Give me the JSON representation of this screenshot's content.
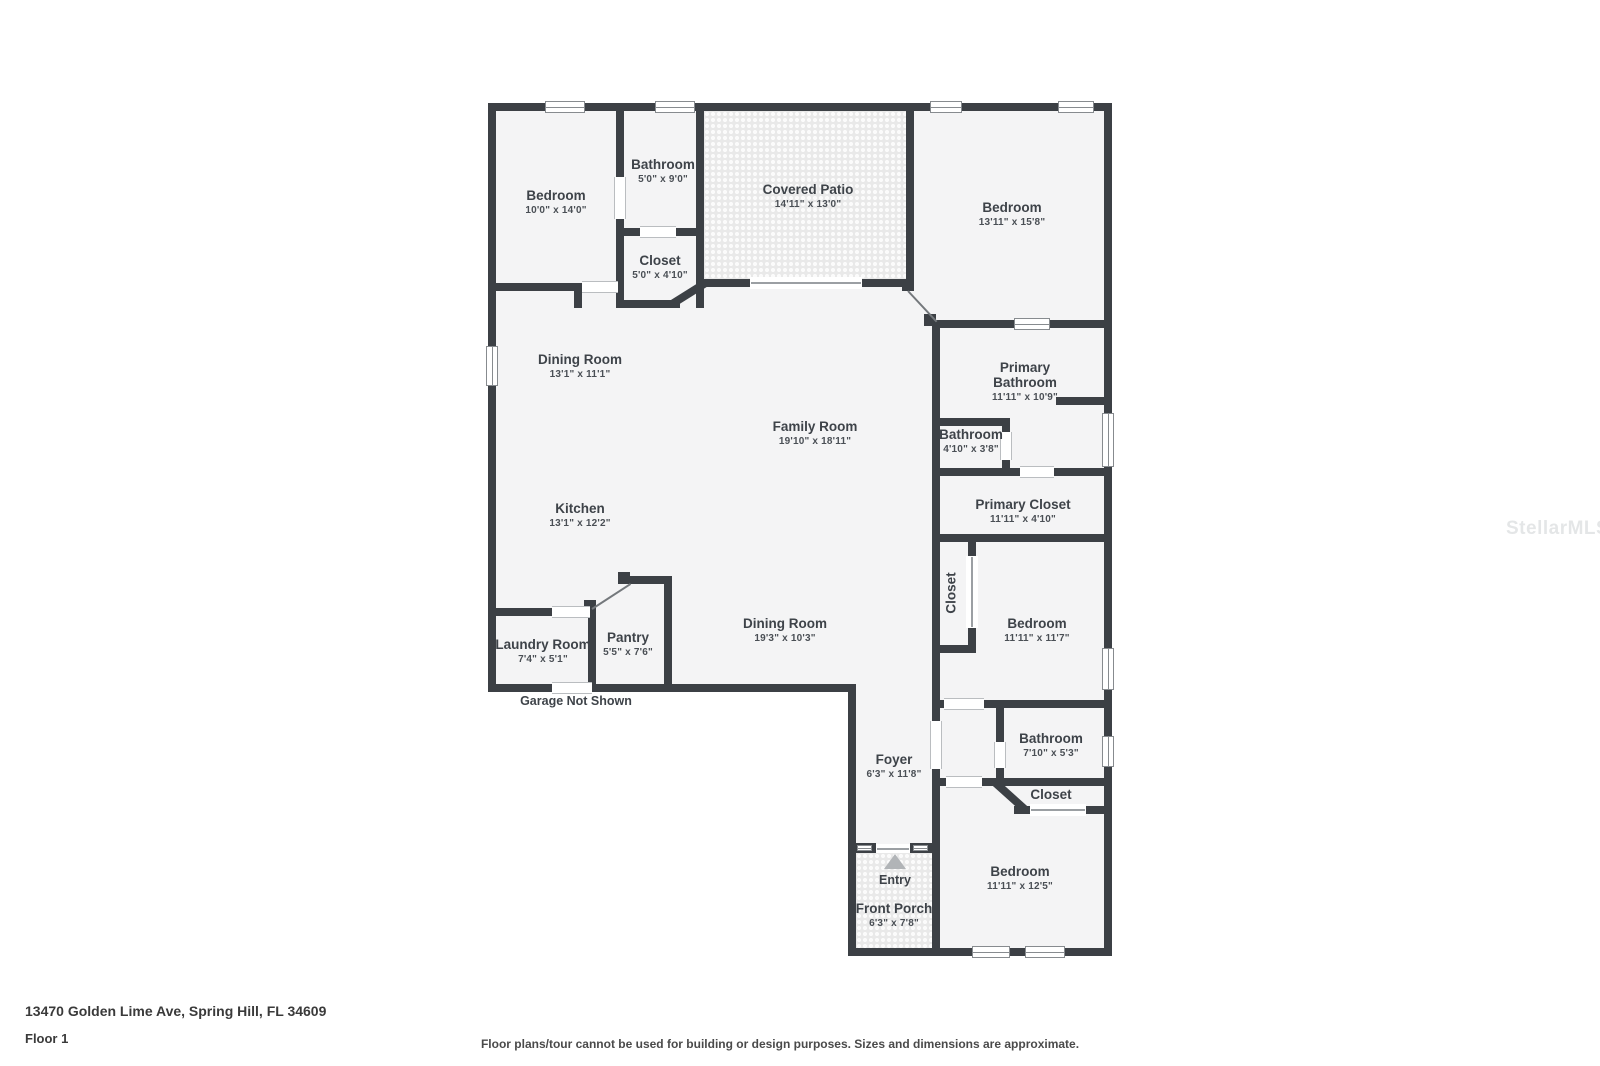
{
  "watermark": "StellarMLS",
  "footer": {
    "address": "13470 Golden Lime Ave, Spring Hill, FL 34609",
    "floor": "Floor 1",
    "disclaimer": "Floor plans/tour cannot be used for building or design purposes. Sizes and dimensions are approximate."
  },
  "notes": {
    "garage": "Garage Not Shown",
    "entry": "Entry"
  },
  "colors": {
    "wall": "#3c4045",
    "room_fill": "#f4f4f5",
    "patio_pattern": "#e9e9e9"
  },
  "rooms": {
    "bedroom1": {
      "name": "Bedroom",
      "dims": "10'0\" x 14'0\""
    },
    "bathroom1": {
      "name": "Bathroom",
      "dims": "5'0\" x 9'0\""
    },
    "closet1": {
      "name": "Closet",
      "dims": "5'0\" x 4'10\""
    },
    "covered_patio": {
      "name": "Covered Patio",
      "dims": "14'11\" x 13'0\""
    },
    "bedroom2": {
      "name": "Bedroom",
      "dims": "13'11\" x 15'8\""
    },
    "dining1": {
      "name": "Dining Room",
      "dims": "13'1\" x 11'1\""
    },
    "family": {
      "name": "Family Room",
      "dims": "19'10\" x 18'11\""
    },
    "kitchen": {
      "name": "Kitchen",
      "dims": "13'1\" x 12'2\""
    },
    "primary_bathroom": {
      "name": "Primary Bathroom",
      "dims": "11'11\" x 10'9\""
    },
    "bathroom3": {
      "name": "Bathroom",
      "dims": "4'10\" x 3'8\""
    },
    "primary_closet": {
      "name": "Primary Closet",
      "dims": "11'11\" x 4'10\""
    },
    "laundry": {
      "name": "Laundry Room",
      "dims": "7'4\" x 5'1\""
    },
    "pantry": {
      "name": "Pantry",
      "dims": "5'5\" x 7'6\""
    },
    "dining2": {
      "name": "Dining Room",
      "dims": "19'3\" x 10'3\""
    },
    "closet3": {
      "name": "Closet",
      "dims": ""
    },
    "bedroom3": {
      "name": "Bedroom",
      "dims": "11'11\" x 11'7\""
    },
    "bathroom2": {
      "name": "Bathroom",
      "dims": "7'10\" x 5'3\""
    },
    "closet2": {
      "name": "Closet",
      "dims": ""
    },
    "foyer": {
      "name": "Foyer",
      "dims": "6'3\" x 11'8\""
    },
    "bedroom4": {
      "name": "Bedroom",
      "dims": "11'11\" x 12'5\""
    },
    "front_porch": {
      "name": "Front Porch",
      "dims": "6'3\" x 7'8\""
    }
  }
}
